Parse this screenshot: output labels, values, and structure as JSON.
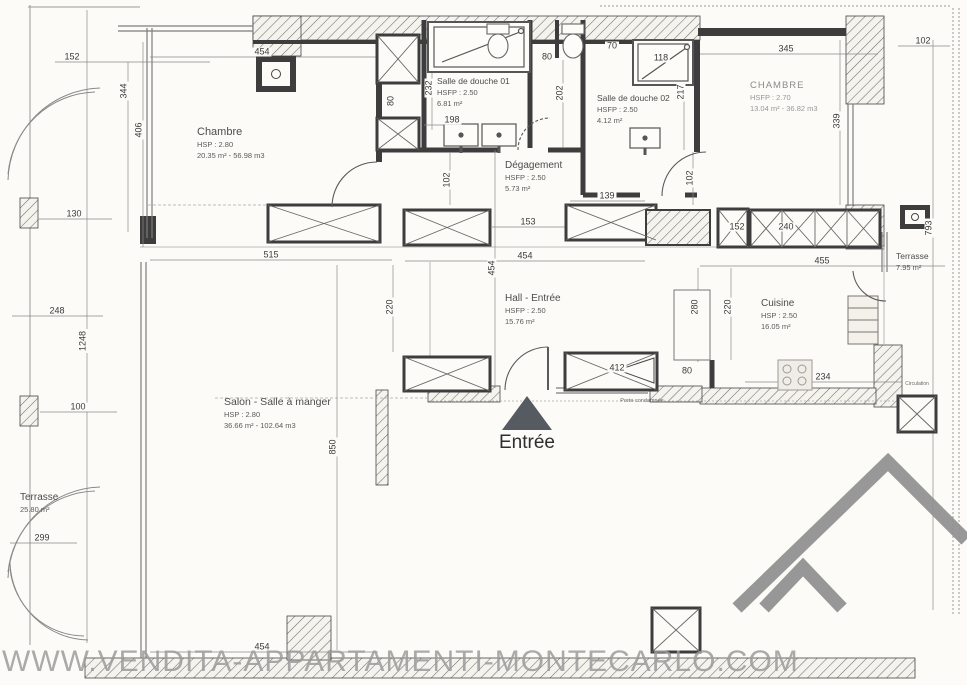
{
  "plan": {
    "rooms": [
      {
        "name": "Chambre",
        "height": "HSP : 2.80",
        "area": "20.35 m² - 56.98 m3"
      },
      {
        "name": "Salle de douche 01",
        "height": "HSFP : 2.50",
        "area": "6.81 m²"
      },
      {
        "name": "Salle de douche 02",
        "height": "HSFP : 2.50",
        "area": "4.12 m²"
      },
      {
        "name": "CHAMBRE",
        "height": "HSFP : 2.70",
        "area": "13.04 m² - 36.82 m3"
      },
      {
        "name": "Dégagement",
        "height": "HSFP : 2.50",
        "area": "5.73 m²"
      },
      {
        "name": "Hall - Entrée",
        "height": "HSFP : 2.50",
        "area": "15.76 m²"
      },
      {
        "name": "Cuisine",
        "height": "HSP : 2.50",
        "area": "16.05 m²"
      },
      {
        "name": "Salon - Salle à manger",
        "height": "HSP : 2.80",
        "area": "36.66 m² - 102.64 m3"
      },
      {
        "name": "Terrasse",
        "area": "7.95 m²"
      },
      {
        "name": "Terrasse",
        "area": "25.80 m²"
      }
    ],
    "entrance_label": "Entrée",
    "annotations": {
      "porte_condamnee": "Porte condamnée",
      "circulation": "Circulation"
    },
    "dims_h": [
      "152",
      "454",
      "102",
      "345",
      "70",
      "118",
      "80",
      "198",
      "130",
      "139",
      "153",
      "152",
      "240",
      "515",
      "454",
      "455",
      "248",
      "100",
      "412",
      "80",
      "234",
      "299",
      "454"
    ],
    "dims_v": [
      "344",
      "406",
      "232",
      "80",
      "202",
      "217",
      "339",
      "793",
      "102",
      "102",
      "1248",
      "220",
      "454",
      "280",
      "220",
      "850"
    ]
  },
  "watermark": "WWW.VENDITA-APPARTAMENTI-MONTECARLO.COM",
  "colors": {
    "wall": "#3d3d3d",
    "paper": "#fcfbf7",
    "watermark": "#9c9c9c"
  }
}
